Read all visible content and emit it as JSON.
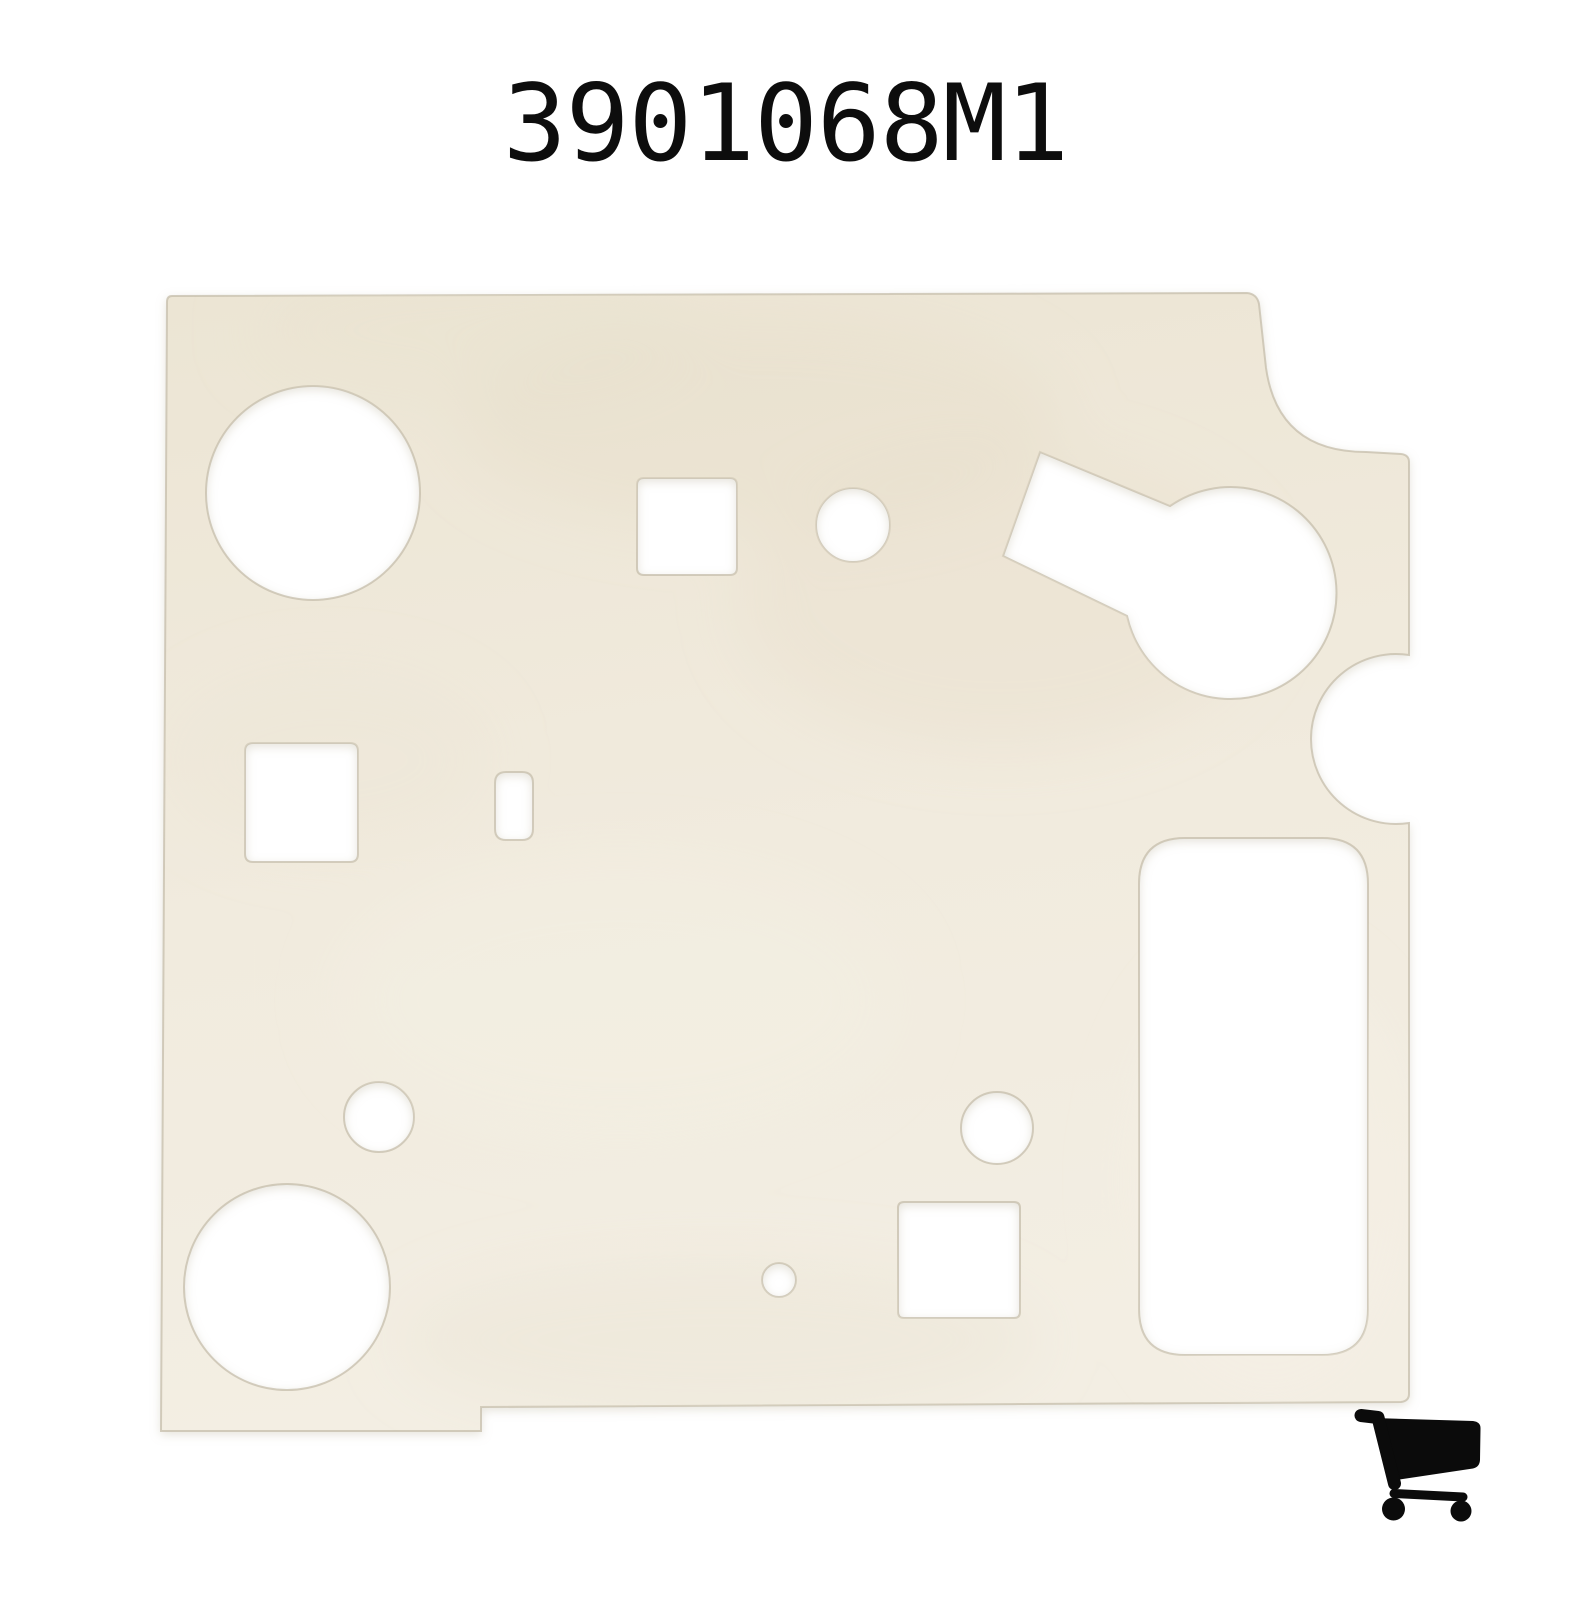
{
  "page": {
    "background": "#ffffff"
  },
  "header": {
    "title": "3901068M1",
    "color": "#0d0d0d"
  },
  "figure": {
    "description_name": "gasket-panel-photo",
    "colors": {
      "panel_top": "#ece5d4",
      "panel_mid": "#f1ebde",
      "panel_bottom": "#f3eee3",
      "edge": "#c6beab",
      "shadow": "#b9b099",
      "cutout": "#ffffff"
    },
    "outline": "M 172 296 L 1247 293 Q 1257 294 1259 304 L 1266 368 Q 1278 452 1366 452 L 1401 454 Q 1409 455 1409 462 L 1409 655 A 85 85 0 1 0 1409 823 L 1409 1394 Q 1409 1401 1401 1402 L 481 1407 L 481 1431 L 161 1431 L 167 302 Q 167 296 172 296 Z",
    "holes": [
      {
        "type": "circle",
        "cx": 313,
        "cy": 493,
        "r": 107
      },
      {
        "type": "rrect",
        "x": 637,
        "y": 478,
        "w": 100,
        "hh": 97,
        "r": 7
      },
      {
        "type": "circle",
        "cx": 853,
        "cy": 525,
        "r": 37
      },
      {
        "type": "path",
        "d": "M 1040 452 L 1170 506 A 106 106 0 1 1 1127 616 L 1003 556 Z"
      },
      {
        "type": "rrect",
        "x": 245,
        "y": 743,
        "w": 113,
        "hh": 119,
        "r": 8
      },
      {
        "type": "rrect",
        "x": 495,
        "y": 772,
        "w": 38,
        "hh": 68,
        "r": 11
      },
      {
        "type": "rrect",
        "x": 1139,
        "y": 838,
        "w": 229,
        "hh": 517,
        "r": 46
      },
      {
        "type": "circle",
        "cx": 379,
        "cy": 1117,
        "r": 35
      },
      {
        "type": "circle",
        "cx": 287,
        "cy": 1287,
        "r": 103
      },
      {
        "type": "circle",
        "cx": 997,
        "cy": 1128,
        "r": 36
      },
      {
        "type": "rrect",
        "x": 898,
        "y": 1202,
        "w": 122,
        "hh": 116,
        "r": 6
      },
      {
        "type": "circle",
        "cx": 779,
        "cy": 1280,
        "r": 17
      }
    ],
    "blotches": [
      {
        "cx": 760,
        "cy": 420,
        "rx": 300,
        "ry": 110,
        "color": "#e6ddca",
        "o": 0.45
      },
      {
        "cx": 1000,
        "cy": 600,
        "rx": 260,
        "ry": 150,
        "color": "#e8dfcc",
        "o": 0.4
      },
      {
        "cx": 470,
        "cy": 330,
        "rx": 220,
        "ry": 70,
        "color": "#e9e1cf",
        "o": 0.35
      },
      {
        "cx": 330,
        "cy": 760,
        "rx": 160,
        "ry": 90,
        "color": "#ece4d3",
        "o": 0.3
      },
      {
        "cx": 620,
        "cy": 1000,
        "rx": 280,
        "ry": 140,
        "color": "#f4efe4",
        "o": 0.5
      },
      {
        "cx": 720,
        "cy": 1340,
        "rx": 320,
        "ry": 80,
        "color": "#e9e1d0",
        "o": 0.35
      },
      {
        "cx": 1270,
        "cy": 1180,
        "rx": 140,
        "ry": 220,
        "color": "#f5f0e6",
        "o": 0.5
      }
    ]
  },
  "cart": {
    "icon": "shopping-cart-icon",
    "color": "#0b0b0b"
  }
}
